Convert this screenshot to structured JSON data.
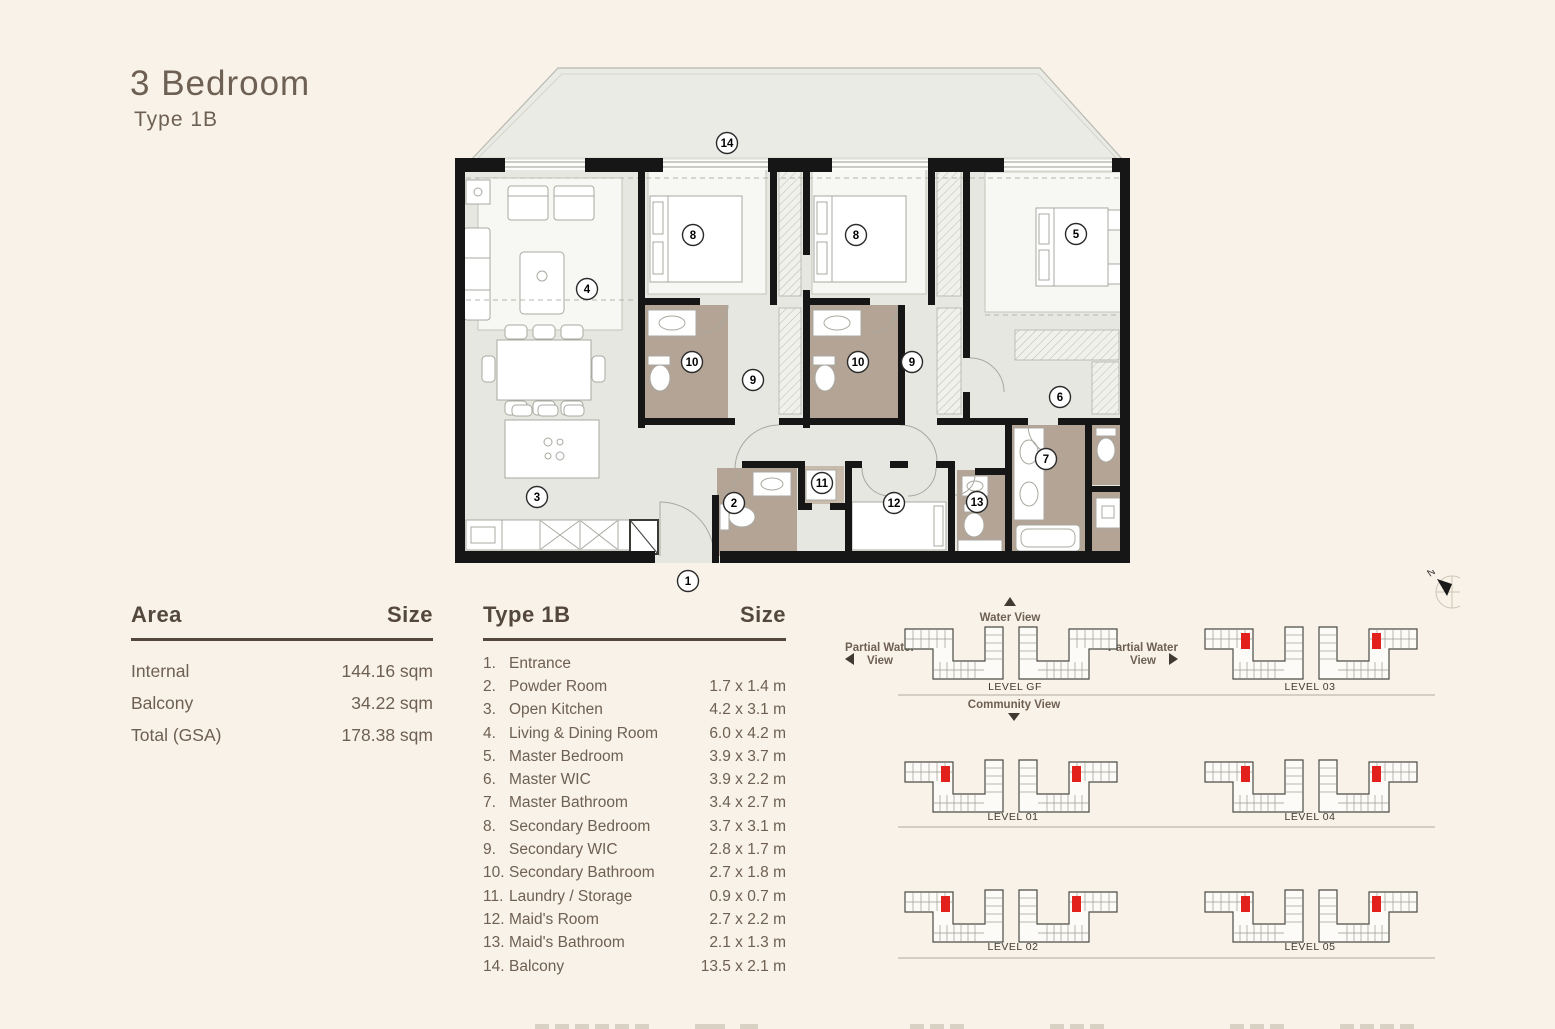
{
  "title": {
    "main": "3 Bedroom",
    "sub": "Type 1B"
  },
  "area_table": {
    "headers": [
      "Area",
      "Size"
    ],
    "rows": [
      {
        "label": "Internal",
        "value": "144.16 sqm"
      },
      {
        "label": "Balcony",
        "value": "34.22 sqm"
      },
      {
        "label": "Total (GSA)",
        "value": "178.38 sqm"
      }
    ]
  },
  "rooms_table": {
    "headers": [
      "Type 1B",
      "Size"
    ],
    "rows": [
      {
        "num": "1.",
        "label": "Entrance",
        "size": ""
      },
      {
        "num": "2.",
        "label": "Powder Room",
        "size": "1.7 x 1.4 m"
      },
      {
        "num": "3.",
        "label": "Open Kitchen",
        "size": "4.2 x 3.1 m"
      },
      {
        "num": "4.",
        "label": "Living & Dining Room",
        "size": "6.0 x 4.2 m"
      },
      {
        "num": "5.",
        "label": "Master Bedroom",
        "size": "3.9 x 3.7 m"
      },
      {
        "num": "6.",
        "label": "Master WIC",
        "size": "3.9 x 2.2 m"
      },
      {
        "num": "7.",
        "label": "Master Bathroom",
        "size": "3.4 x 2.7 m"
      },
      {
        "num": "8.",
        "label": "Secondary Bedroom",
        "size": "3.7 x 3.1 m"
      },
      {
        "num": "9.",
        "label": "Secondary WIC",
        "size": "2.8 x 1.7 m"
      },
      {
        "num": "10.",
        "label": "Secondary Bathroom",
        "size": "2.7 x 1.8 m"
      },
      {
        "num": "11.",
        "label": "Laundry / Storage",
        "size": "0.9 x 0.7 m"
      },
      {
        "num": "12.",
        "label": "Maid's Room",
        "size": "2.7 x 2.2 m"
      },
      {
        "num": "13.",
        "label": "Maid's Bathroom",
        "size": "2.1 x 1.3 m"
      },
      {
        "num": "14.",
        "label": "Balcony",
        "size": "13.5 x 2.1 m"
      }
    ]
  },
  "floor_plan": {
    "markers": [
      "1",
      "2",
      "3",
      "4",
      "5",
      "6",
      "7",
      "8",
      "8",
      "9",
      "9",
      "10",
      "10",
      "11",
      "12",
      "13",
      "14"
    ],
    "colors": {
      "floor": "#e6e7e0",
      "balcony": "#e9ebe4",
      "bathroom": "#b4a496",
      "wall": "#161616",
      "furniture_line": "#a9a9a1"
    }
  },
  "levels": {
    "compass_n": "N",
    "views": {
      "water": "Water View",
      "partial_line1": "Partial Water",
      "partial_line2": "View",
      "community": "Community View"
    },
    "rows": [
      {
        "left": "LEVEL GF",
        "right": "LEVEL 03"
      },
      {
        "left": "LEVEL 01",
        "right": "LEVEL 04"
      },
      {
        "left": "LEVEL 02",
        "right": "LEVEL 05"
      }
    ],
    "highlight_color": "#e2201c"
  }
}
